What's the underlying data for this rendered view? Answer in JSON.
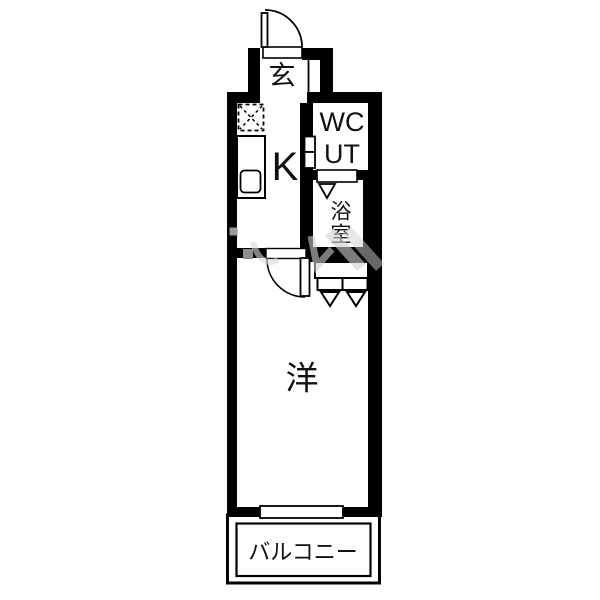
{
  "colors": {
    "wall": "#000000",
    "background": "#ffffff",
    "text": "#111111",
    "watermark": "#d0d0d0"
  },
  "floorplan": {
    "type": "japanese-apartment-floorplan-1K",
    "rooms": {
      "entrance": {
        "label": "玄"
      },
      "kitchen": {
        "label": "K"
      },
      "wc": {
        "label": "WC"
      },
      "utility": {
        "label": "UT"
      },
      "bathroom": {
        "label": "浴室",
        "chars": [
          "浴",
          "室"
        ]
      },
      "western": {
        "label": "洋"
      },
      "balcony": {
        "label": "バルコニー"
      }
    },
    "symbols": [
      "entrance-door-swing",
      "room-door-swing",
      "refrigerator-space",
      "kitchen-sink-counter",
      "wc-door-marker",
      "bathroom-folding-door",
      "closet-folding-door",
      "balcony-window",
      "watermark"
    ]
  }
}
